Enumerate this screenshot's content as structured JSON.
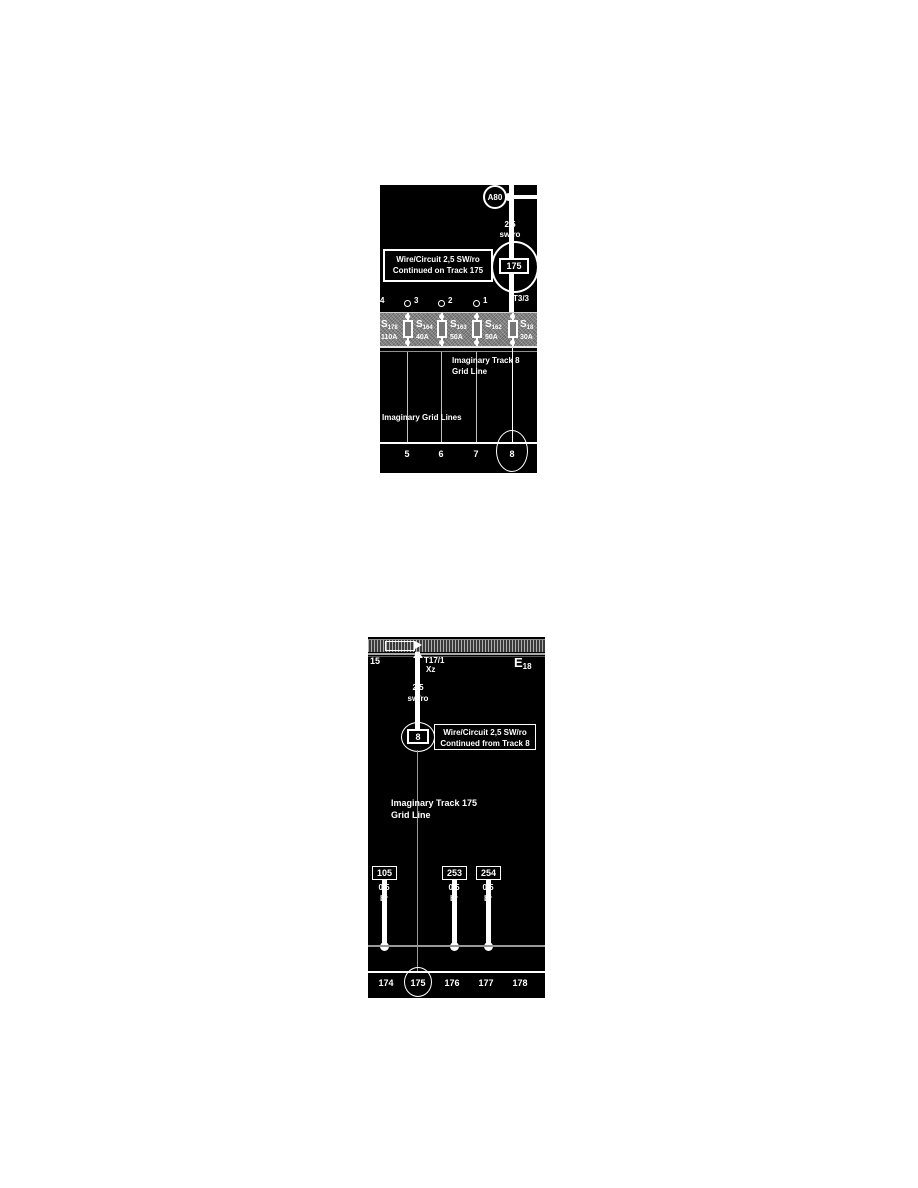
{
  "colors": {
    "panel_bg": "#000000",
    "line": "#ffffff",
    "fuse_strip": "#8a8a8a",
    "imaginary_grid_line": "#c0c0c0",
    "bus_line": "#999999"
  },
  "top_panel": {
    "component": "A80",
    "wire": {
      "size": "2,5",
      "color": "sw/ro"
    },
    "continuation_ref": "175",
    "callout": {
      "line1": "Wire/Circuit 2,5 SW/ro",
      "line2": "Continued on Track 175"
    },
    "terminal_pins": [
      "4",
      "3",
      "2",
      "1",
      "T3/3"
    ],
    "fuses": [
      {
        "name": "S",
        "sub": "178",
        "rating": "110A"
      },
      {
        "name": "S",
        "sub": "164",
        "rating": "40A"
      },
      {
        "name": "S",
        "sub": "163",
        "rating": "50A"
      },
      {
        "name": "S",
        "sub": "162",
        "rating": "50A"
      },
      {
        "name": "S",
        "sub": "18",
        "rating": "30A"
      }
    ],
    "track8_note": {
      "line1": "Imaginary Track 8",
      "line2": "Grid Line"
    },
    "gridlines_note": "Imaginary Grid Lines",
    "tracks": [
      "5",
      "6",
      "7",
      "8"
    ],
    "highlighted_track": "8"
  },
  "bottom_panel": {
    "terminal_label": "15",
    "connector": "T17/1",
    "connector_pin": "Xz",
    "component": {
      "name": "E",
      "sub": "18"
    },
    "wire": {
      "size": "2,5",
      "color": "sw/ro"
    },
    "continuation_ref": "8",
    "callout": {
      "line1": "Wire/Circuit 2,5 SW/ro",
      "line2": "Continued from Track 8"
    },
    "track175_note": {
      "line1": "Imaginary Track 175",
      "line2": "Grid Line"
    },
    "wires": [
      {
        "id": "105",
        "size": "0,5",
        "color": "br"
      },
      {
        "id": "253",
        "size": "0,5",
        "color": "br"
      },
      {
        "id": "254",
        "size": "0,5",
        "color": "br"
      }
    ],
    "tracks": [
      "174",
      "175",
      "176",
      "177",
      "178"
    ],
    "highlighted_track": "175"
  }
}
